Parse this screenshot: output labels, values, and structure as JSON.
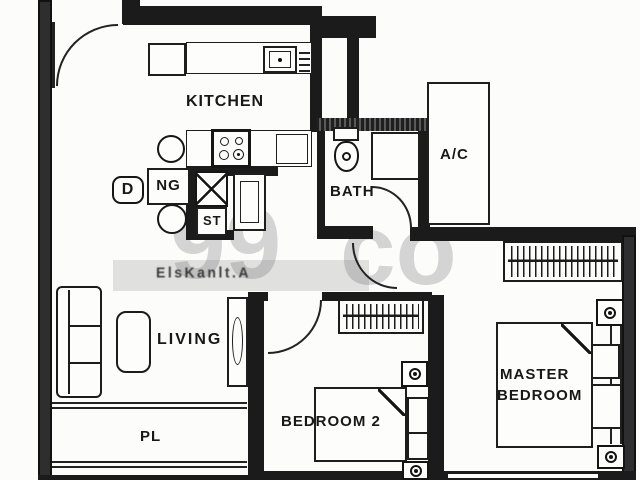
{
  "title": "2-bedroom apartment floor plan (scanned)",
  "watermark": {
    "part1": "99",
    "part2": "co"
  },
  "overlay": {
    "garbled_text": "ElsKanlt.A"
  },
  "colors": {
    "line": "#1b1b1b",
    "paper": "#fcfcfa",
    "watermark_gray": "#bdbdbd"
  },
  "rooms": {
    "kitchen": {
      "label": "KITCHEN"
    },
    "dining": {
      "letter": "D",
      "suffix": "NG"
    },
    "store": {
      "label": "ST"
    },
    "bath": {
      "label": "BATH"
    },
    "ac_ledge": {
      "label": "A/C"
    },
    "living": {
      "label": "LIVING"
    },
    "planter": {
      "label": "PL"
    },
    "bedroom2": {
      "label": "BEDROOM 2"
    },
    "master": {
      "line1": "MASTER",
      "line2": "BEDROOM"
    }
  }
}
